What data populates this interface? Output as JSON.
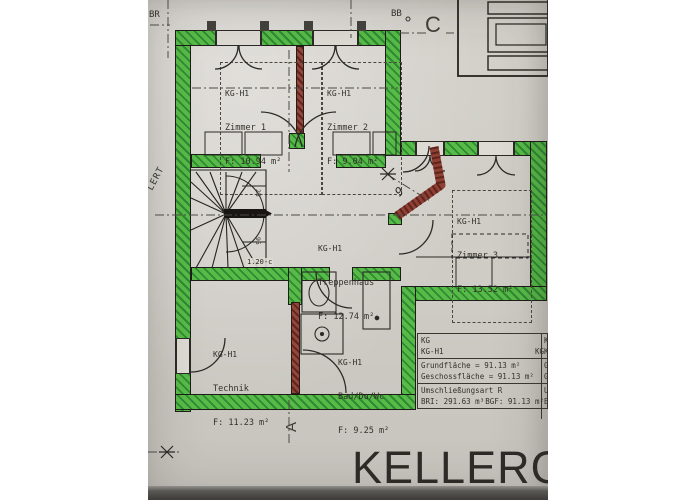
{
  "title": {
    "text": "KELLERG"
  },
  "markers": {
    "top_left": "BR",
    "top_right": "BB",
    "section_c": "C",
    "section_a": "A",
    "left_rotated": "LERT",
    "diag_number": "9"
  },
  "rooms": [
    {
      "code": "KG-H1",
      "name": "Zimmer 1",
      "area": "F: 10.94 m²"
    },
    {
      "code": "KG-H1",
      "name": "Zimmer 2",
      "area": "F: 9.04 m²"
    },
    {
      "code": "KG-H1",
      "name": "Zimmer 3",
      "area": "F: 13.52 m²"
    },
    {
      "code": "KG-H1",
      "name": "Treppenhaus",
      "area": "F: 12.74 m²"
    },
    {
      "code": "KG-H1",
      "name": "Technik",
      "area": "F: 11.23 m²"
    },
    {
      "code": "KG-H1",
      "name": "Bad/Du/Wc",
      "area": "F: 9.25 m²"
    }
  ],
  "info_table": {
    "rows": [
      {
        "l": "KG",
        "r": ""
      },
      {
        "l": "KG-H1",
        "r": "KG"
      },
      {
        "l": "Grundfläche = 91.13 m²",
        "r": ""
      },
      {
        "l": "Geschossfläche = 91.13 m²",
        "r": ""
      },
      {
        "l": "Umschließungsart R",
        "r": ""
      },
      {
        "l": "BRI: 291.63 m³",
        "r": "BGF: 91.13 m²"
      }
    ]
  },
  "stair": {
    "dim_top": "25",
    "dim_mid": "95",
    "wall_dim": "1.20-c"
  },
  "colors": {
    "wall_green": "#58bb48",
    "wall_red": "#95463a",
    "paper": "#cfccc6",
    "line": "#2b2a26"
  }
}
